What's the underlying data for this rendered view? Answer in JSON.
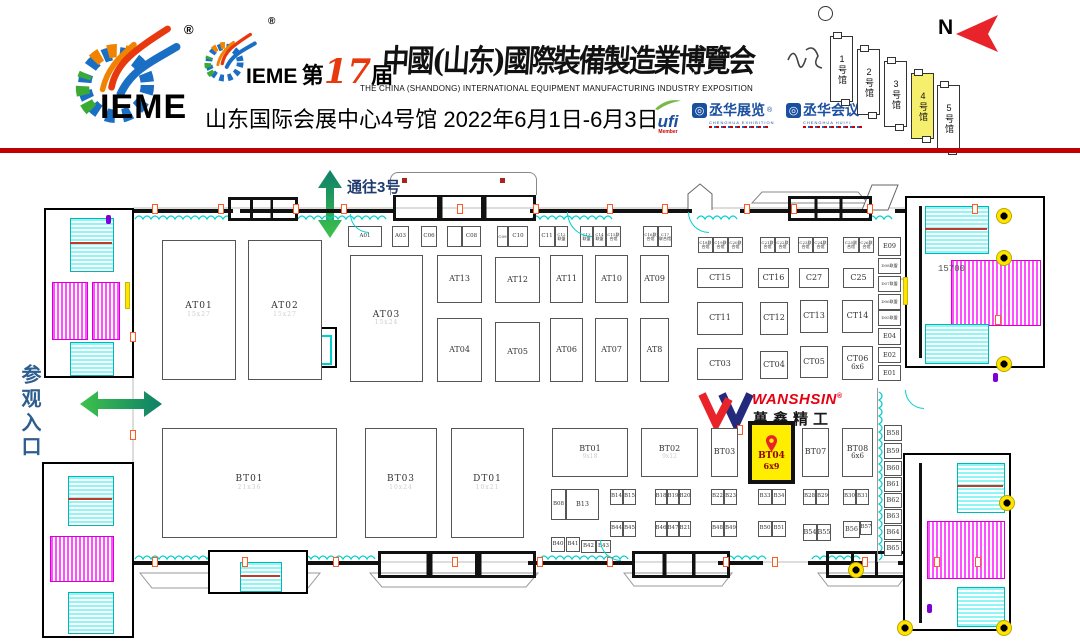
{
  "header": {
    "brand": "IEME",
    "reg": "®",
    "edition": {
      "pre": "第",
      "num": "17",
      "post": "届",
      "brand2": "IEME"
    },
    "title_cn": "中國(山东)國際裝備製造業博覽会",
    "title_en": "THE CHINA (SHANDONG) INTERNATIONAL EQUIPMENT MANUFACTURING INDUSTRY EXPOSITION",
    "venue": "山东国际会展中心4号馆 2022年6月1日-6月3日",
    "ufi": {
      "name": "ufi",
      "member": "Member"
    },
    "partners": [
      {
        "name": "丞华展览",
        "reg": "®",
        "sub": "CHENGHUA EXHIBITION"
      },
      {
        "name": "丞华会议",
        "reg": "®",
        "sub": "CHENGHUA HUIYI"
      }
    ],
    "compass": "N",
    "halls": [
      {
        "label": "1号馆",
        "active": false
      },
      {
        "label": "2号馆",
        "active": false
      },
      {
        "label": "3号馆",
        "active": false
      },
      {
        "label": "4号馆",
        "active": true
      },
      {
        "label": "5号馆",
        "active": false
      }
    ]
  },
  "map": {
    "to_hall3": "通往3号",
    "entrance": "参观入口",
    "dimension": "15700",
    "wanshsin": {
      "en": "WANSHSIN",
      "reg": "®",
      "cn": "萬鑫精工"
    },
    "highlighted_booth": {
      "id": "BT04",
      "size": "6x9"
    },
    "booths": [
      {
        "id": "AT01",
        "t": "lg",
        "x": 162,
        "y": 240,
        "w": 74,
        "h": 140,
        "sub": "15x27",
        "fa": 1
      },
      {
        "id": "AT02",
        "t": "lg",
        "x": 248,
        "y": 240,
        "w": 74,
        "h": 140,
        "sub": "15x27",
        "fa": 1
      },
      {
        "id": "AT03",
        "t": "lg",
        "x": 350,
        "y": 255,
        "w": 73,
        "h": 127,
        "sub": "15x24",
        "fa": 1
      },
      {
        "id": "AT13",
        "t": "md",
        "x": 437,
        "y": 255,
        "w": 45,
        "h": 48
      },
      {
        "id": "AT12",
        "t": "md",
        "x": 495,
        "y": 257,
        "w": 45,
        "h": 46
      },
      {
        "id": "AT11",
        "t": "md",
        "x": 550,
        "y": 255,
        "w": 33,
        "h": 48
      },
      {
        "id": "AT10",
        "t": "md",
        "x": 595,
        "y": 255,
        "w": 33,
        "h": 48
      },
      {
        "id": "AT09",
        "t": "md",
        "x": 640,
        "y": 255,
        "w": 29,
        "h": 48
      },
      {
        "id": "AT04",
        "t": "md",
        "x": 437,
        "y": 318,
        "w": 45,
        "h": 64
      },
      {
        "id": "AT05",
        "t": "md",
        "x": 495,
        "y": 322,
        "w": 45,
        "h": 60
      },
      {
        "id": "AT06",
        "t": "md",
        "x": 550,
        "y": 318,
        "w": 33,
        "h": 64
      },
      {
        "id": "AT07",
        "t": "md",
        "x": 595,
        "y": 318,
        "w": 33,
        "h": 64
      },
      {
        "id": "AT8",
        "t": "md",
        "x": 640,
        "y": 318,
        "w": 29,
        "h": 64
      },
      {
        "id": "A01",
        "t": "sm",
        "x": 348,
        "y": 226,
        "w": 34,
        "h": 21
      },
      {
        "id": "A03",
        "t": "sm",
        "x": 392,
        "y": 226,
        "w": 17,
        "h": 21
      },
      {
        "id": "C06",
        "t": "sm",
        "x": 421,
        "y": 226,
        "w": 16,
        "h": 21
      },
      {
        "id": "",
        "t": "sm",
        "x": 447,
        "y": 226,
        "w": 15,
        "h": 21
      },
      {
        "id": "C08",
        "t": "sm",
        "x": 462,
        "y": 226,
        "w": 19,
        "h": 21
      },
      {
        "id": "C09",
        "t": "mc",
        "x": 497,
        "y": 226,
        "w": 11,
        "h": 21
      },
      {
        "id": "C10",
        "t": "sm",
        "x": 508,
        "y": 226,
        "w": 20,
        "h": 21
      },
      {
        "id": "C11",
        "t": "sm",
        "x": 539,
        "y": 226,
        "w": 16,
        "h": 21
      },
      {
        "id": "C12联盟",
        "t": "mc",
        "x": 555,
        "y": 226,
        "w": 13,
        "h": 21
      },
      {
        "id": "C13联盟",
        "t": "mc",
        "x": 580,
        "y": 226,
        "w": 13,
        "h": 21
      },
      {
        "id": "C14联盟",
        "t": "mc",
        "x": 593,
        "y": 226,
        "w": 13,
        "h": 21
      },
      {
        "id": "C15联合馆",
        "t": "mc",
        "x": 606,
        "y": 226,
        "w": 15,
        "h": 21
      },
      {
        "id": "C16联合馆",
        "t": "mc",
        "x": 643,
        "y": 226,
        "w": 15,
        "h": 21
      },
      {
        "id": "C17联合馆",
        "t": "mc",
        "x": 658,
        "y": 226,
        "w": 14,
        "h": 21
      },
      {
        "id": "C18联合馆",
        "t": "mc",
        "x": 698,
        "y": 237,
        "w": 15,
        "h": 16
      },
      {
        "id": "C19联合馆",
        "t": "mc",
        "x": 713,
        "y": 237,
        "w": 15,
        "h": 16
      },
      {
        "id": "C20联合馆",
        "t": "mc",
        "x": 728,
        "y": 237,
        "w": 15,
        "h": 16
      },
      {
        "id": "C21联合馆",
        "t": "mc",
        "x": 760,
        "y": 237,
        "w": 15,
        "h": 16
      },
      {
        "id": "C22联合馆",
        "t": "mc",
        "x": 775,
        "y": 237,
        "w": 15,
        "h": 16
      },
      {
        "id": "C23联合馆",
        "t": "mc",
        "x": 798,
        "y": 237,
        "w": 15,
        "h": 16
      },
      {
        "id": "C24联合馆",
        "t": "mc",
        "x": 813,
        "y": 237,
        "w": 15,
        "h": 16
      },
      {
        "id": "C25联合馆",
        "t": "mc",
        "x": 843,
        "y": 237,
        "w": 16,
        "h": 16
      },
      {
        "id": "C26联合馆",
        "t": "mc",
        "x": 859,
        "y": 237,
        "w": 15,
        "h": 16
      },
      {
        "id": "CT15",
        "t": "md",
        "x": 697,
        "y": 268,
        "w": 46,
        "h": 20
      },
      {
        "id": "CT16",
        "t": "md",
        "x": 758,
        "y": 268,
        "w": 31,
        "h": 20
      },
      {
        "id": "C27",
        "t": "md",
        "x": 799,
        "y": 268,
        "w": 30,
        "h": 20
      },
      {
        "id": "C25",
        "t": "md",
        "x": 843,
        "y": 268,
        "w": 31,
        "h": 20
      },
      {
        "id": "CT11",
        "t": "md",
        "x": 697,
        "y": 302,
        "w": 46,
        "h": 33
      },
      {
        "id": "CT12",
        "t": "md",
        "x": 760,
        "y": 302,
        "w": 28,
        "h": 33
      },
      {
        "id": "CT13",
        "t": "md",
        "x": 800,
        "y": 300,
        "w": 28,
        "h": 33
      },
      {
        "id": "CT14",
        "t": "md",
        "x": 842,
        "y": 300,
        "w": 31,
        "h": 33
      },
      {
        "id": "CT03",
        "t": "md",
        "x": 697,
        "y": 348,
        "w": 46,
        "h": 32
      },
      {
        "id": "CT04",
        "t": "md",
        "x": 760,
        "y": 351,
        "w": 28,
        "h": 28
      },
      {
        "id": "CT05",
        "t": "md",
        "x": 800,
        "y": 346,
        "w": 28,
        "h": 32
      },
      {
        "id": "CT06",
        "t": "md",
        "x": 842,
        "y": 346,
        "w": 31,
        "h": 34,
        "sub": "6x6"
      },
      {
        "id": "E09",
        "t": "ec",
        "x": 878,
        "y": 237,
        "w": 23,
        "h": 19
      },
      {
        "id": "D08联盟",
        "t": "mc",
        "x": 878,
        "y": 258,
        "w": 23,
        "h": 16
      },
      {
        "id": "D07联盟",
        "t": "mc",
        "x": 878,
        "y": 276,
        "w": 23,
        "h": 16
      },
      {
        "id": "D06联盟",
        "t": "mc",
        "x": 878,
        "y": 294,
        "w": 23,
        "h": 16
      },
      {
        "id": "D05联盟",
        "t": "mc",
        "x": 878,
        "y": 310,
        "w": 23,
        "h": 16
      },
      {
        "id": "E04",
        "t": "ec",
        "x": 878,
        "y": 328,
        "w": 23,
        "h": 17
      },
      {
        "id": "E02",
        "t": "ec",
        "x": 878,
        "y": 347,
        "w": 23,
        "h": 16
      },
      {
        "id": "E01",
        "t": "ec",
        "x": 878,
        "y": 365,
        "w": 23,
        "h": 16
      },
      {
        "id": "BT01",
        "t": "lg",
        "x": 162,
        "y": 428,
        "w": 175,
        "h": 110,
        "sub": "21x36",
        "fa": 1
      },
      {
        "id": "BT03",
        "t": "lg",
        "x": 365,
        "y": 428,
        "w": 72,
        "h": 110,
        "sub": "10x24",
        "fa": 1
      },
      {
        "id": "DT01",
        "t": "lg",
        "x": 451,
        "y": 428,
        "w": 73,
        "h": 110,
        "sub": "10x21",
        "fa": 1
      },
      {
        "id": "BT01",
        "t": "md",
        "x": 552,
        "y": 428,
        "w": 76,
        "h": 49,
        "sub": "9x18",
        "fa": 1
      },
      {
        "id": "BT02",
        "t": "md",
        "x": 641,
        "y": 428,
        "w": 57,
        "h": 49,
        "sub": "9x12",
        "fa": 1
      },
      {
        "id": "BT03",
        "t": "md",
        "x": 711,
        "y": 428,
        "w": 27,
        "h": 49
      },
      {
        "id": "BT04",
        "t": "hl",
        "x": 748,
        "y": 421,
        "w": 47,
        "h": 63,
        "sub": "6x9"
      },
      {
        "id": "BT07",
        "t": "md",
        "x": 802,
        "y": 428,
        "w": 27,
        "h": 49
      },
      {
        "id": "BT08",
        "t": "md",
        "x": 842,
        "y": 428,
        "w": 31,
        "h": 49,
        "sub": "6x6"
      },
      {
        "id": "B58",
        "t": "ec",
        "x": 884,
        "y": 425,
        "w": 18,
        "h": 16
      },
      {
        "id": "B59",
        "t": "ec",
        "x": 884,
        "y": 443,
        "w": 18,
        "h": 16
      },
      {
        "id": "B60",
        "t": "ec",
        "x": 884,
        "y": 461,
        "w": 18,
        "h": 15
      },
      {
        "id": "B61",
        "t": "ec",
        "x": 884,
        "y": 477,
        "w": 18,
        "h": 15
      },
      {
        "id": "B62",
        "t": "ec",
        "x": 884,
        "y": 493,
        "w": 18,
        "h": 15
      },
      {
        "id": "B63",
        "t": "ec",
        "x": 884,
        "y": 509,
        "w": 18,
        "h": 15
      },
      {
        "id": "B64",
        "t": "ec",
        "x": 884,
        "y": 525,
        "w": 18,
        "h": 15
      },
      {
        "id": "B65",
        "t": "ec",
        "x": 884,
        "y": 541,
        "w": 18,
        "h": 15
      },
      {
        "id": "B08",
        "t": "sm",
        "x": 551,
        "y": 489,
        "w": 15,
        "h": 31
      },
      {
        "id": "B13",
        "t": "ec",
        "x": 566,
        "y": 489,
        "w": 33,
        "h": 31
      },
      {
        "id": "B14",
        "t": "sm",
        "x": 610,
        "y": 489,
        "w": 13,
        "h": 16
      },
      {
        "id": "B15",
        "t": "sm",
        "x": 623,
        "y": 489,
        "w": 13,
        "h": 16
      },
      {
        "id": "B18",
        "t": "sm",
        "x": 655,
        "y": 489,
        "w": 12,
        "h": 16
      },
      {
        "id": "B19",
        "t": "sm",
        "x": 667,
        "y": 489,
        "w": 12,
        "h": 16
      },
      {
        "id": "B20",
        "t": "sm",
        "x": 679,
        "y": 489,
        "w": 12,
        "h": 16
      },
      {
        "id": "B22",
        "t": "sm",
        "x": 711,
        "y": 489,
        "w": 13,
        "h": 16
      },
      {
        "id": "B23",
        "t": "sm",
        "x": 724,
        "y": 489,
        "w": 13,
        "h": 16
      },
      {
        "id": "B33",
        "t": "sm",
        "x": 758,
        "y": 489,
        "w": 14,
        "h": 16
      },
      {
        "id": "B34",
        "t": "sm",
        "x": 772,
        "y": 489,
        "w": 14,
        "h": 16
      },
      {
        "id": "B28",
        "t": "sm",
        "x": 803,
        "y": 489,
        "w": 13,
        "h": 16
      },
      {
        "id": "B29",
        "t": "sm",
        "x": 816,
        "y": 489,
        "w": 13,
        "h": 16
      },
      {
        "id": "B30",
        "t": "sm",
        "x": 843,
        "y": 489,
        "w": 13,
        "h": 16
      },
      {
        "id": "B31",
        "t": "sm",
        "x": 856,
        "y": 489,
        "w": 13,
        "h": 16
      },
      {
        "id": "B44",
        "t": "sm",
        "x": 610,
        "y": 521,
        "w": 13,
        "h": 16
      },
      {
        "id": "B45",
        "t": "sm",
        "x": 623,
        "y": 521,
        "w": 13,
        "h": 16
      },
      {
        "id": "B46",
        "t": "sm",
        "x": 655,
        "y": 521,
        "w": 12,
        "h": 16
      },
      {
        "id": "B47",
        "t": "sm",
        "x": 667,
        "y": 521,
        "w": 12,
        "h": 16
      },
      {
        "id": "B21",
        "t": "sm",
        "x": 679,
        "y": 521,
        "w": 12,
        "h": 16
      },
      {
        "id": "B48",
        "t": "sm",
        "x": 711,
        "y": 521,
        "w": 13,
        "h": 16
      },
      {
        "id": "B49",
        "t": "sm",
        "x": 724,
        "y": 521,
        "w": 13,
        "h": 16
      },
      {
        "id": "B50",
        "t": "sm",
        "x": 758,
        "y": 521,
        "w": 14,
        "h": 16
      },
      {
        "id": "B51",
        "t": "sm",
        "x": 772,
        "y": 521,
        "w": 14,
        "h": 16
      },
      {
        "id": "B54",
        "t": "ec",
        "x": 803,
        "y": 524,
        "w": 14,
        "h": 17
      },
      {
        "id": "B55",
        "t": "ec",
        "x": 817,
        "y": 524,
        "w": 14,
        "h": 17
      },
      {
        "id": "B56",
        "t": "ec",
        "x": 843,
        "y": 521,
        "w": 17,
        "h": 17
      },
      {
        "id": "B57",
        "t": "sm",
        "x": 860,
        "y": 521,
        "w": 12,
        "h": 14
      },
      {
        "id": "B40",
        "t": "sm",
        "x": 551,
        "y": 537,
        "w": 14,
        "h": 15
      },
      {
        "id": "B41",
        "t": "sm",
        "x": 566,
        "y": 537,
        "w": 14,
        "h": 15
      },
      {
        "id": "B42",
        "t": "sm",
        "x": 581,
        "y": 540,
        "w": 15,
        "h": 13
      },
      {
        "id": "B43",
        "t": "sm",
        "x": 596,
        "y": 540,
        "w": 15,
        "h": 13
      }
    ]
  },
  "colors": {
    "accent_red": "#c00000",
    "highlight_yellow": "#ffee00",
    "pin_red": "#e8232a",
    "arrow_green": "#3fc24a",
    "arrow_teal": "#0e7f6a",
    "cad_cyan": "#00cfcf",
    "cad_magenta": "#ff4dff"
  }
}
